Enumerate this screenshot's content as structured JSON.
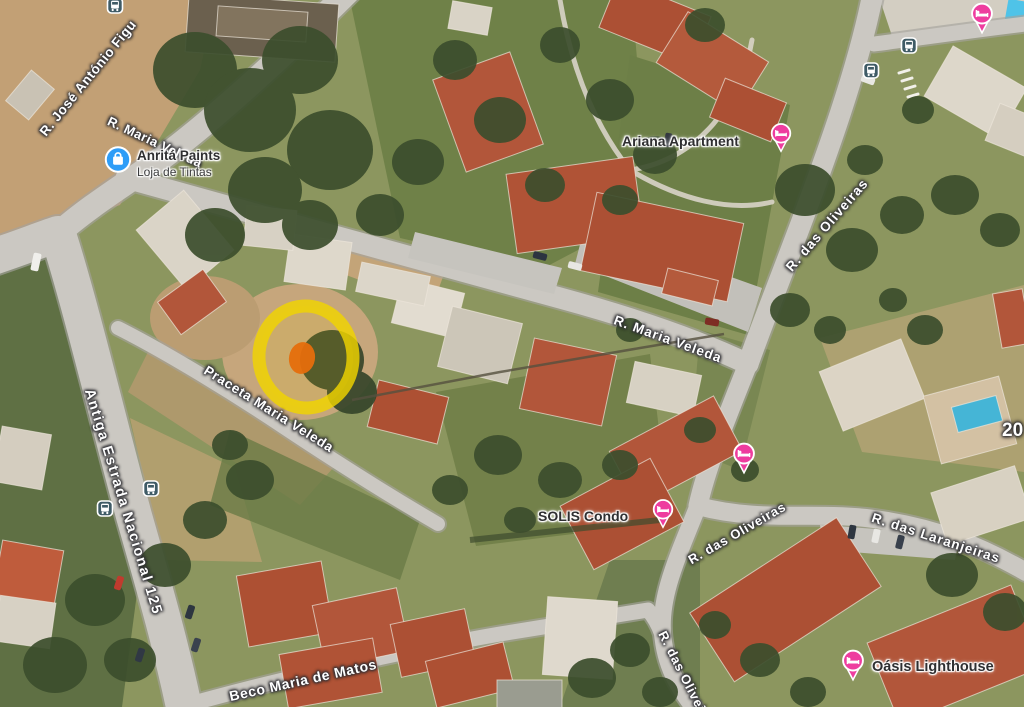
{
  "map": {
    "kind": "satellite-aerial-view",
    "roads": [
      {
        "name": "jose-antonio-figueiredo",
        "text": "R. José António Figu"
      },
      {
        "name": "maria-veleda-west",
        "text": "R. Maria Veleda"
      },
      {
        "name": "maria-veleda",
        "text": "R. Maria Veleda"
      },
      {
        "name": "oliveiras-north",
        "text": "R. das Oliveiras"
      },
      {
        "name": "antiga-estrada-125",
        "text": "Antiga Estrada Nacional 125"
      },
      {
        "name": "praceta-maria-veleda",
        "text": "Praceta Maria Veleda"
      },
      {
        "name": "oliveiras-mid",
        "text": "R. das Oliveiras"
      },
      {
        "name": "laranjeiras",
        "text": "R. das Laranjeiras"
      },
      {
        "name": "oliveiras-south",
        "text": "R. das Oliveiras"
      },
      {
        "name": "beco-maria-de-matos",
        "text": "Beco Maria de Matos"
      }
    ],
    "house_number": "20",
    "places": {
      "anrita": {
        "title": "Anritá Paints",
        "subtitle": "Loja de Tintas",
        "icon": "shopping-bag"
      },
      "ariana": {
        "title": "Ariana Apartment",
        "icon": "lodging"
      },
      "solis": {
        "title": "SOLIS Condo",
        "icon": "lodging"
      },
      "oasis": {
        "title": "Oásis Lighthouse",
        "icon": "lodging"
      }
    },
    "markers": {
      "bus_stops": [
        [
          115,
          8
        ],
        [
          909,
          48
        ],
        [
          871,
          73
        ],
        [
          151,
          491
        ],
        [
          105,
          511
        ]
      ],
      "lodging_pins": [
        [
          982,
          20
        ],
        [
          744,
          460
        ]
      ]
    },
    "colors": {
      "lodging_pink": "#ee3d9f",
      "business_blue": "#2e9df7",
      "transit_badge": "#3f5b66",
      "highlight_ring": "#f0d400",
      "highlight_spot": "#e55f0e"
    }
  }
}
